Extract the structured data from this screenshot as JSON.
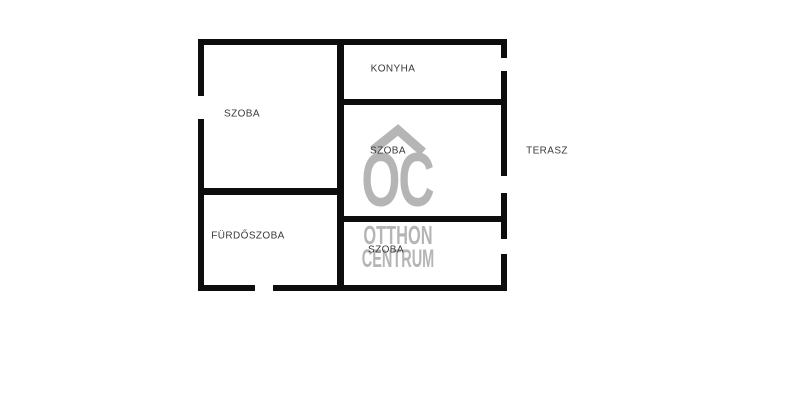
{
  "floorplan": {
    "rooms": {
      "szoba_left": {
        "label": "SZOBA"
      },
      "konyha": {
        "label": "KONYHA"
      },
      "szoba_middle": {
        "label": "SZOBA"
      },
      "terasz": {
        "label": "TERASZ"
      },
      "furdoszoba": {
        "label": "FÜRDŐSZOBA"
      },
      "szoba_bottom": {
        "label": "SZOBA"
      }
    },
    "watermark": {
      "icon": "roof-icon",
      "monogram": "OC",
      "line1": "OTTHON",
      "line2": "CENTRUM"
    },
    "colors": {
      "background": "#ffffff",
      "wall": "#0d0d0d",
      "label": "#3a3a3a",
      "watermark": "#b5b5b5"
    }
  }
}
